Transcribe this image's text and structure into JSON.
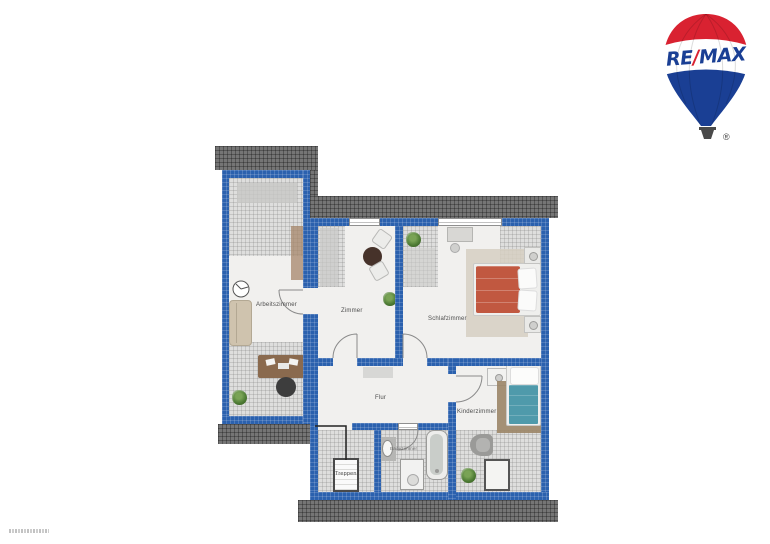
{
  "logo": {
    "part_re": "RE",
    "slash": "/",
    "part_max": "MAX",
    "registered": "®"
  },
  "floorplan": {
    "rooms": [
      {
        "id": "arbeitszimmer",
        "label": "Arbeitszimmer"
      },
      {
        "id": "zimmer",
        "label": "Zimmer"
      },
      {
        "id": "schlafzimmer",
        "label": "Schlafzimmer"
      },
      {
        "id": "flur",
        "label": "Flur"
      },
      {
        "id": "kinderzimmer",
        "label": "Kinderzimmer"
      },
      {
        "id": "treppen",
        "label": "Treppen"
      },
      {
        "id": "badezimmer",
        "label": "Badezimmer"
      }
    ]
  },
  "colors": {
    "wall": "#2b61ae",
    "roof": "#757575",
    "floor": "#f1f0ee",
    "brand_blue": "#1a3f94",
    "brand_red": "#d92231",
    "basket_gray": "#4a4a4a",
    "bed_red": "#c15840",
    "bed_teal": "#4f9aab",
    "rug_brown": "#9b8567",
    "rug_beige": "#d6cfc2",
    "desk_brown": "#8a6a4e",
    "sofa_beige": "#cfc3ae",
    "plant_green": "#4c7a33"
  }
}
